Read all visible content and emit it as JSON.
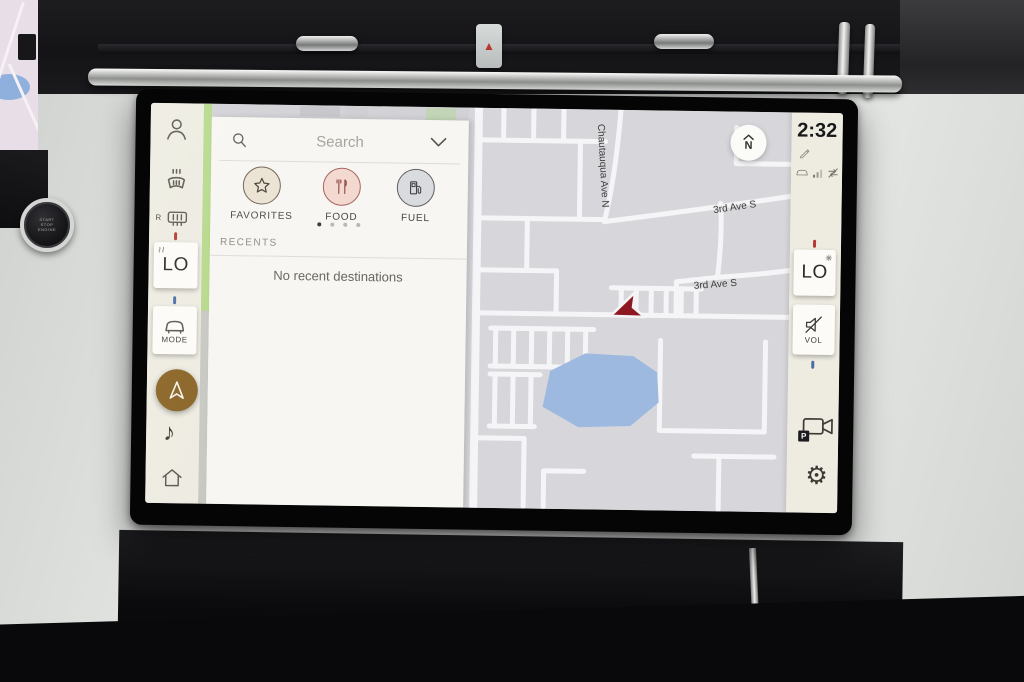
{
  "statusbar": {
    "time": "2:32"
  },
  "sidebar": {
    "rear_defrost_prefix": "R",
    "temp_button_label": "LO",
    "mode_button_label": "MODE"
  },
  "search_panel": {
    "search_placeholder": "Search",
    "categories": [
      {
        "label": "FAVORITES",
        "icon": "star-icon"
      },
      {
        "label": "FOOD",
        "icon": "dining-icon"
      },
      {
        "label": "FUEL",
        "icon": "fuel-pump-icon"
      }
    ],
    "page_dots": {
      "count": 4,
      "active_index": 0
    },
    "recents_header": "RECENTS",
    "recents_empty": "No recent destinations"
  },
  "map": {
    "compass_label": "N",
    "streets": [
      {
        "name": "Chautauqua Ave N"
      },
      {
        "name": "US-19 N"
      },
      {
        "name": "3rd Ave S"
      },
      {
        "name": "3rd Ave S"
      }
    ]
  },
  "right_rail": {
    "temp_button_label": "LO",
    "volume_button_label": "VOL",
    "parking_badge": "P"
  },
  "dashboard": {
    "start_button": [
      "START",
      "STOP",
      "ENGINE"
    ]
  },
  "glyphs": {
    "music_note": "♪",
    "gear": "⚙",
    "warning": "▲"
  },
  "colors": {
    "accent_green": "#b6d98a",
    "nav_active_brown": "#8a6426",
    "marker_red": "#8e1822",
    "water_blue": "#9db9e0",
    "hot_tick": "#b23b32",
    "cold_tick": "#4a6fa5"
  }
}
